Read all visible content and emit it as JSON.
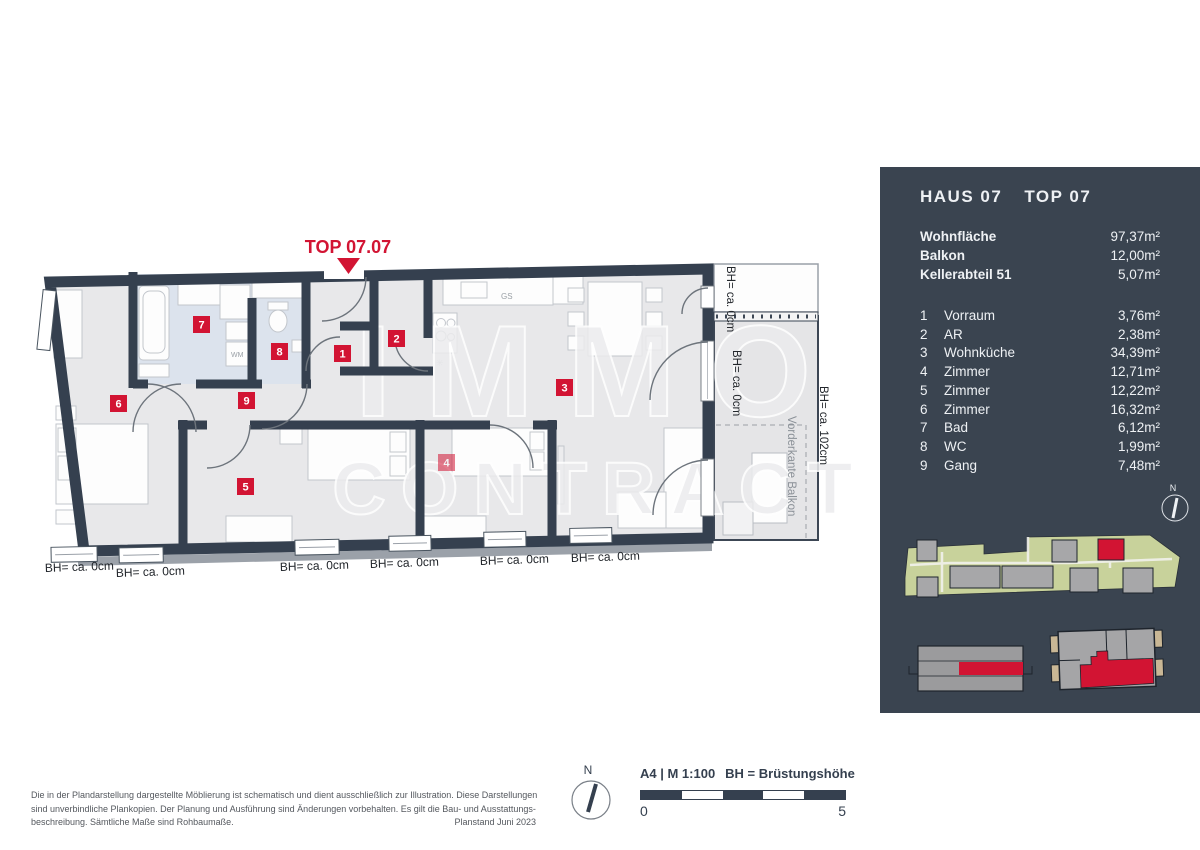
{
  "plan": {
    "title": "TOP 07.07",
    "window_height_label": "BH= ca. 0cm",
    "balcony_height_label": "BH= ca. 102cm",
    "balcony_edge_label": "Vorderkante Balkon",
    "washer_label": "WM",
    "dishwasher_label": "GS",
    "badges": [
      "1",
      "2",
      "3",
      "4",
      "5",
      "6",
      "7",
      "8",
      "9"
    ],
    "watermark_line1": "IMMO",
    "watermark_line2": "CONTRACT"
  },
  "panel": {
    "house_label": "HAUS 07",
    "top_label": "TOP 07",
    "summary": [
      {
        "label": "Wohnfläche",
        "value": "97,37m²"
      },
      {
        "label": "Balkon",
        "value": "12,00m²"
      },
      {
        "label": "Kellerabteil 51",
        "value": "5,07m²"
      }
    ],
    "rooms": [
      {
        "num": "1",
        "name": "Vorraum",
        "area": "3,76m²"
      },
      {
        "num": "2",
        "name": "AR",
        "area": "2,38m²"
      },
      {
        "num": "3",
        "name": "Wohnküche",
        "area": "34,39m²"
      },
      {
        "num": "4",
        "name": "Zimmer",
        "area": "12,71m²"
      },
      {
        "num": "5",
        "name": "Zimmer",
        "area": "12,22m²"
      },
      {
        "num": "6",
        "name": "Zimmer",
        "area": "16,32m²"
      },
      {
        "num": "7",
        "name": "Bad",
        "area": "6,12m²"
      },
      {
        "num": "8",
        "name": "WC",
        "area": "1,99m²"
      },
      {
        "num": "9",
        "name": "Gang",
        "area": "7,48m²"
      }
    ],
    "compass_label": "N"
  },
  "footer": {
    "disclaimer_line1": "Die in der Plandarstellung dargestellte Möblierung ist schematisch und dient ausschließlich zur Illustration. Diese Darstellungen",
    "disclaimer_line2": "sind unverbindliche Plankopien. Der Planung und Ausführung sind Änderungen vorbehalten. Es gilt die Bau- und Ausstattungs-",
    "disclaimer_line3": "beschreibung. Sämtliche Maße sind Rohbaumaße.",
    "plan_date": "Planstand Juni 2023",
    "format_scale": "A4 | M 1:100",
    "bh_legend": "BH = Brüstungshöhe",
    "scale_start": "0",
    "scale_end": "5",
    "compass_label": "N"
  },
  "colors": {
    "accent_red": "#d21433",
    "panel_bg": "#3a4450",
    "wall": "#35404f",
    "site_green": "#c8d29b"
  }
}
